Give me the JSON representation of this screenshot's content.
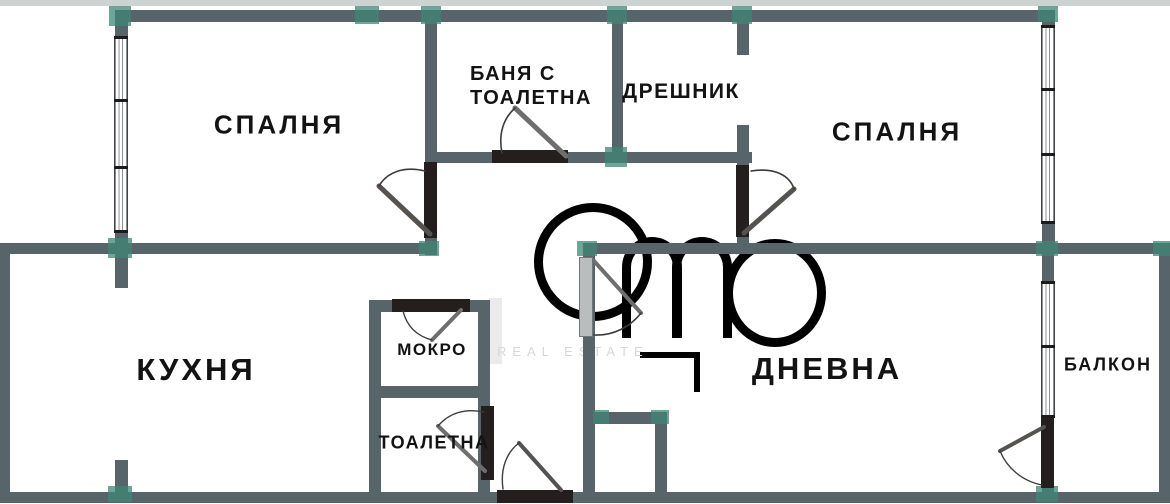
{
  "colors": {
    "wall": "#57646a",
    "joint": "#3f8577",
    "door": "#241f1e",
    "text": "#131313",
    "wm": "#ebebeb"
  },
  "rooms": {
    "bedroom_left": {
      "label": "СПАЛНЯ"
    },
    "bathroom": {
      "label_line1": "БАНЯ С",
      "label_line2": "ТОАЛЕТНА"
    },
    "closet": {
      "label": "ДРЕШНИК"
    },
    "bedroom_right": {
      "label": "СПАЛНЯ"
    },
    "kitchen": {
      "label": "КУХНЯ"
    },
    "utility": {
      "label": "МОКРО"
    },
    "toilet": {
      "label": "ТОАЛЕТНА"
    },
    "living": {
      "label": "ДНЕВНА"
    },
    "balcony": {
      "label": "БАЛКОН"
    }
  },
  "watermark": {
    "text": "REAL ESTATE"
  }
}
